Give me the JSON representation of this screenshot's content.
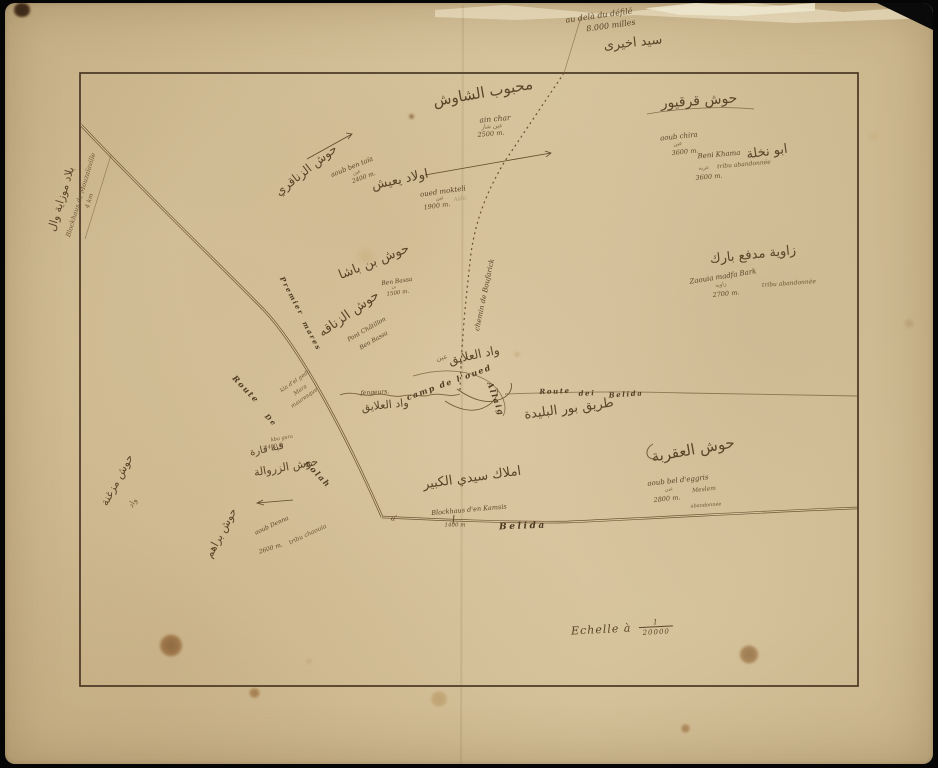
{
  "map": {
    "colors": {
      "paper": "#d6c39c",
      "ink": "#5a4428",
      "road_ink": "#6f5634",
      "border_line": "#4a3723",
      "background": "#060606",
      "stain": "#7a4a1f"
    },
    "scale": {
      "prefix": "Echelle à",
      "numerator": "1",
      "denominator": "20000"
    },
    "labels": [
      {
        "text": "au delà du défilé",
        "x": 594,
        "y": 13,
        "rot": -8,
        "size": 8,
        "cls": "fr"
      },
      {
        "text": "8.000 milles",
        "x": 606,
        "y": 23,
        "rot": -8,
        "size": 8,
        "cls": "fr"
      },
      {
        "text": "سيد اخيرى",
        "x": 628,
        "y": 40,
        "rot": -6,
        "size": 13,
        "cls": "ar"
      },
      {
        "text": "بلاد موزاية وال",
        "x": 56,
        "y": 196,
        "rot": -73,
        "size": 11,
        "cls": "ar"
      },
      {
        "text": "Blockhaus de Mouzaïaville",
        "x": 76,
        "y": 192,
        "rot": -73,
        "size": 6.5,
        "cls": "frs"
      },
      {
        "text": "4 km",
        "x": 85,
        "y": 198,
        "rot": -73,
        "size": 6,
        "cls": "frs"
      },
      {
        "text": "محبوب الشاوش",
        "x": 478,
        "y": 90,
        "rot": -10,
        "size": 15,
        "cls": "ar"
      },
      {
        "text": "ain char",
        "x": 490,
        "y": 116,
        "rot": -5,
        "size": 7.5,
        "cls": "fr"
      },
      {
        "text": "عين شار",
        "x": 487,
        "y": 124,
        "rot": -5,
        "size": 6,
        "cls": "ars"
      },
      {
        "text": "2500 m.",
        "x": 486,
        "y": 131,
        "rot": -5,
        "size": 6.5,
        "cls": "num"
      },
      {
        "text": "حوش قرقيور",
        "x": 694,
        "y": 98,
        "rot": -4,
        "size": 14,
        "cls": "ar"
      },
      {
        "text": "aoub chira",
        "x": 674,
        "y": 134,
        "rot": -6,
        "size": 7,
        "cls": "fr"
      },
      {
        "text": "عين",
        "x": 673,
        "y": 142,
        "rot": -6,
        "size": 5.5,
        "cls": "ars"
      },
      {
        "text": "3600 m.",
        "x": 680,
        "y": 149,
        "rot": -6,
        "size": 6.5,
        "cls": "num"
      },
      {
        "text": "Beni Khama",
        "x": 714,
        "y": 152,
        "rot": -5,
        "size": 7,
        "cls": "fr"
      },
      {
        "text": "ابو نخلة",
        "x": 762,
        "y": 149,
        "rot": -8,
        "size": 13,
        "cls": "ar"
      },
      {
        "text": "tribu abandonnée",
        "x": 739,
        "y": 162,
        "rot": -5,
        "size": 6,
        "cls": "frs"
      },
      {
        "text": "عربه",
        "x": 699,
        "y": 166,
        "rot": -5,
        "size": 5.5,
        "cls": "ars"
      },
      {
        "text": "3600 m.",
        "x": 704,
        "y": 174,
        "rot": -5,
        "size": 6.5,
        "cls": "num"
      },
      {
        "text": "زاوية مدفع بارك",
        "x": 748,
        "y": 252,
        "rot": -6,
        "size": 13,
        "cls": "ar"
      },
      {
        "text": "Zaouia madfa Bark",
        "x": 718,
        "y": 274,
        "rot": -9,
        "size": 7,
        "cls": "fr"
      },
      {
        "text": "tribu abandonnée",
        "x": 784,
        "y": 281,
        "rot": -4,
        "size": 6,
        "cls": "frs"
      },
      {
        "text": "زاويه",
        "x": 716,
        "y": 283,
        "rot": -8,
        "size": 5.5,
        "cls": "ars"
      },
      {
        "text": "2700 m.",
        "x": 721,
        "y": 291,
        "rot": -6,
        "size": 6.5,
        "cls": "num"
      },
      {
        "text": "حوش الزناقري",
        "x": 301,
        "y": 167,
        "rot": -38,
        "size": 12,
        "cls": "ar"
      },
      {
        "text": "aoub ben taïa",
        "x": 347,
        "y": 164,
        "rot": -22,
        "size": 6.5,
        "cls": "fr"
      },
      {
        "text": "عين",
        "x": 352,
        "y": 170,
        "rot": -20,
        "size": 5,
        "cls": "ars"
      },
      {
        "text": "2400 m.",
        "x": 359,
        "y": 175,
        "rot": -20,
        "size": 6,
        "cls": "num"
      },
      {
        "text": "اولاد يعيش",
        "x": 395,
        "y": 177,
        "rot": -12,
        "size": 13,
        "cls": "ar"
      },
      {
        "text": "oued mokteli",
        "x": 438,
        "y": 189,
        "rot": -8,
        "size": 7,
        "cls": "fr"
      },
      {
        "text": "عين",
        "x": 435,
        "y": 196,
        "rot": -8,
        "size": 5,
        "cls": "ars"
      },
      {
        "text": "Aida",
        "x": 455,
        "y": 197,
        "rot": -8,
        "size": 5.5,
        "cls": "frl"
      },
      {
        "text": "1900 m.",
        "x": 432,
        "y": 203,
        "rot": -8,
        "size": 6.5,
        "cls": "num"
      },
      {
        "text": "حوش بن باشا",
        "x": 369,
        "y": 259,
        "rot": -22,
        "size": 13,
        "cls": "ar"
      },
      {
        "text": "Ben Bassa",
        "x": 392,
        "y": 279,
        "rot": -8,
        "size": 6,
        "cls": "fr"
      },
      {
        "text": "بن",
        "x": 389,
        "y": 285,
        "rot": -8,
        "size": 4.5,
        "cls": "ars"
      },
      {
        "text": "1500 m.",
        "x": 393,
        "y": 291,
        "rot": -8,
        "size": 5.5,
        "cls": "num"
      },
      {
        "text": "حوش الزناقه",
        "x": 344,
        "y": 311,
        "rot": -35,
        "size": 13,
        "cls": "ar"
      },
      {
        "text": "Pont Châtillon",
        "x": 362,
        "y": 327,
        "rot": -30,
        "size": 6,
        "cls": "fr"
      },
      {
        "text": "Ben Bassa",
        "x": 369,
        "y": 338,
        "rot": -30,
        "size": 6,
        "cls": "fr"
      },
      {
        "text": "Premier",
        "x": 287,
        "y": 293,
        "rot": 62,
        "size": 7,
        "cls": "road"
      },
      {
        "text": "mares",
        "x": 307,
        "y": 333,
        "rot": 62,
        "size": 7,
        "cls": "road"
      },
      {
        "text": "chemin de Boufarick",
        "x": 480,
        "y": 292,
        "rot": -78,
        "size": 7,
        "cls": "fr"
      },
      {
        "text": "واد العلايق",
        "x": 469,
        "y": 352,
        "rot": -12,
        "size": 12,
        "cls": "ar"
      },
      {
        "text": "عين",
        "x": 437,
        "y": 355,
        "rot": -10,
        "size": 7,
        "cls": "ars"
      },
      {
        "text": "camp de l'oued",
        "x": 444,
        "y": 379,
        "rot": -20,
        "size": 8,
        "cls": "road"
      },
      {
        "text": "Allaig",
        "x": 491,
        "y": 396,
        "rot": 70,
        "size": 8,
        "cls": "road"
      },
      {
        "text": "Route",
        "x": 550,
        "y": 388,
        "rot": -2,
        "size": 7,
        "cls": "road"
      },
      {
        "text": "dei",
        "x": 582,
        "y": 390,
        "rot": -2,
        "size": 7,
        "cls": "road"
      },
      {
        "text": "Belida",
        "x": 621,
        "y": 391,
        "rot": -4,
        "size": 7,
        "cls": "road"
      },
      {
        "text": "طريق بور البليدة",
        "x": 564,
        "y": 406,
        "rot": -8,
        "size": 13,
        "cls": "ar"
      },
      {
        "text": "Route",
        "x": 241,
        "y": 386,
        "rot": 46,
        "size": 8,
        "cls": "road"
      },
      {
        "text": "De",
        "x": 266,
        "y": 417,
        "rot": 46,
        "size": 7,
        "cls": "road"
      },
      {
        "text": "Colah",
        "x": 313,
        "y": 471,
        "rot": 46,
        "size": 8,
        "cls": "road"
      },
      {
        "text": "kla d'el geda",
        "x": 291,
        "y": 379,
        "rot": -35,
        "size": 5.5,
        "cls": "frs"
      },
      {
        "text": "Mara",
        "x": 296,
        "y": 388,
        "rot": -35,
        "size": 5.5,
        "cls": "frs"
      },
      {
        "text": "mauresque",
        "x": 300,
        "y": 396,
        "rot": -35,
        "size": 5.5,
        "cls": "frs"
      },
      {
        "text": "fengeurs.",
        "x": 370,
        "y": 390,
        "rot": -3,
        "size": 6,
        "cls": "fr"
      },
      {
        "text": "واد العلايق",
        "x": 380,
        "y": 402,
        "rot": -6,
        "size": 11,
        "cls": "ar"
      },
      {
        "text": "kba  gara",
        "x": 277,
        "y": 436,
        "rot": -10,
        "size": 5,
        "cls": "frs"
      },
      {
        "text": "1400 m",
        "x": 269,
        "y": 444,
        "rot": -10,
        "size": 5,
        "cls": "num"
      },
      {
        "text": "قبة قارة",
        "x": 262,
        "y": 447,
        "rot": -12,
        "size": 10,
        "cls": "ar"
      },
      {
        "text": "حوش الزروالة",
        "x": 281,
        "y": 464,
        "rot": -10,
        "size": 11,
        "cls": "ar"
      },
      {
        "text": "حوش براهم",
        "x": 216,
        "y": 530,
        "rot": -62,
        "size": 11,
        "cls": "ar"
      },
      {
        "text": "حوش مزغنة",
        "x": 112,
        "y": 477,
        "rot": -62,
        "size": 11,
        "cls": "ar"
      },
      {
        "text": "واد",
        "x": 128,
        "y": 500,
        "rot": -58,
        "size": 8,
        "cls": "ars"
      },
      {
        "text": "aoub Denna",
        "x": 267,
        "y": 523,
        "rot": -25,
        "size": 6,
        "cls": "fr"
      },
      {
        "text": "tribu chaouia",
        "x": 303,
        "y": 532,
        "rot": -25,
        "size": 6,
        "cls": "frs"
      },
      {
        "text": "2600 m.",
        "x": 266,
        "y": 546,
        "rot": -18,
        "size": 6,
        "cls": "num"
      },
      {
        "text": "املاك سيدي الكبير",
        "x": 467,
        "y": 475,
        "rot": -8,
        "size": 13,
        "cls": "ar"
      },
      {
        "text": "حوش العقربة",
        "x": 688,
        "y": 447,
        "rot": -10,
        "size": 15,
        "cls": "ar"
      },
      {
        "text": "aoub bel d'eggris",
        "x": 673,
        "y": 478,
        "rot": -6,
        "size": 7,
        "cls": "fr"
      },
      {
        "text": "Meslem",
        "x": 699,
        "y": 487,
        "rot": -6,
        "size": 6,
        "cls": "frs"
      },
      {
        "text": "عين",
        "x": 664,
        "y": 487,
        "rot": -6,
        "size": 5,
        "cls": "ars"
      },
      {
        "text": "2800 m.",
        "x": 662,
        "y": 496,
        "rot": -6,
        "size": 6.5,
        "cls": "num"
      },
      {
        "text": "abandonnée",
        "x": 701,
        "y": 503,
        "rot": -4,
        "size": 5,
        "cls": "frs"
      },
      {
        "text": "a'",
        "x": 389,
        "y": 516,
        "rot": 0,
        "size": 7,
        "cls": "fr"
      },
      {
        "text": "Blockhaus d'en Kamsis",
        "x": 464,
        "y": 507,
        "rot": -5,
        "size": 6.5,
        "cls": "fr"
      },
      {
        "text": "1400 m",
        "x": 450,
        "y": 523,
        "rot": 0,
        "size": 5.5,
        "cls": "num"
      },
      {
        "text": "Belida",
        "x": 518,
        "y": 524,
        "rot": -2,
        "size": 9,
        "cls": "roadb"
      }
    ]
  }
}
